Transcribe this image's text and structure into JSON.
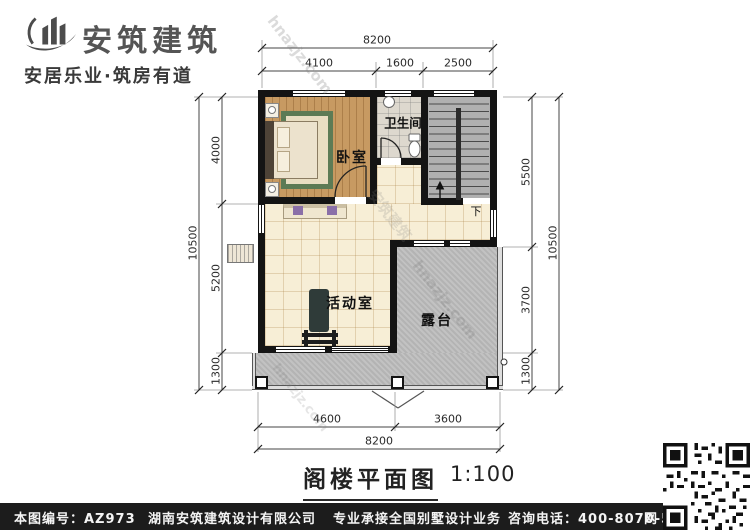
{
  "logo": {
    "brand": "安筑建筑",
    "tagline": "安居乐业·筑房有道"
  },
  "plan": {
    "rooms": {
      "bedroom": "卧室",
      "bathroom": "卫生间",
      "activity": "活动室",
      "terrace": "露台",
      "stair_down": "下"
    },
    "dimensions": {
      "top": {
        "total": "8200",
        "seg1": "4100",
        "seg2": "1600",
        "seg3": "2500"
      },
      "bottom": {
        "total": "8200",
        "seg1": "4600",
        "seg2": "3600"
      },
      "left": {
        "total": "10500",
        "seg1": "4000",
        "seg2": "5200",
        "seg3": "1300"
      },
      "right": {
        "total": "10500",
        "seg1": "5500",
        "seg2": "3700",
        "seg3": "1300"
      }
    }
  },
  "title": {
    "name": "阁楼平面图",
    "scale": "1:100"
  },
  "watermark": {
    "site": "hnazjz.com",
    "brand": "安筑建筑"
  },
  "footer": {
    "plan_no": "本图编号：AZ973",
    "company": "湖南安筑建筑设计有限公司",
    "service": "专业承接全国别墅设计业务",
    "phone": "咨询电话：400-8070-511",
    "web": "网"
  },
  "colors": {
    "wall": "#141414",
    "wood_floor": "#c79a62",
    "tile_floor": "#f7eed6",
    "terrace": "#bdbdbd",
    "stairs": "#b0b0b0",
    "rug_border": "#5d7b55",
    "accent_purple": "#8a6fa8",
    "footer_bg": "#1c1c1c"
  }
}
